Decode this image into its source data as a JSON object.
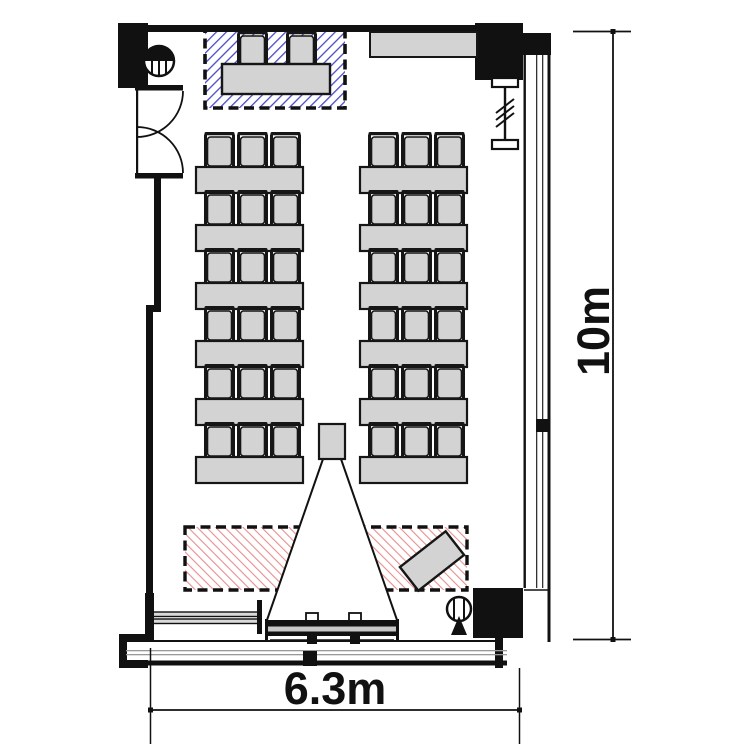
{
  "title": "seminar room floor plan",
  "dimensions": {
    "height_label": "10m",
    "width_label": "6.3m"
  },
  "zones": {
    "instructor": {
      "name": "instructor desk zone",
      "hatch": "blue",
      "hatch_color": "#4a4ac6",
      "border_style": "black dashed"
    },
    "presentation": {
      "name": "presentation / screen zone",
      "hatch": "red",
      "hatch_color": "#e88e8e",
      "border_style": "black dashed"
    }
  },
  "seating": {
    "columns": 2,
    "tables_per_column": 6,
    "chairs_per_table": 3,
    "total_student_seats": 36,
    "instructor_desk_chairs": 2
  },
  "equipment": [
    "entrance-double-door",
    "wall-counter",
    "instructor-desk",
    "projector",
    "projection-cone",
    "projection-screen",
    "whiteboard-rail",
    "lectern",
    "column-symbol",
    "sprinkler-symbol",
    "brace-symbol"
  ],
  "colors": {
    "wall": "#111111",
    "furniture_fill": "#d3d3d3",
    "blue_hatch": "#4a4ac6",
    "red_hatch": "#e88e8e"
  }
}
